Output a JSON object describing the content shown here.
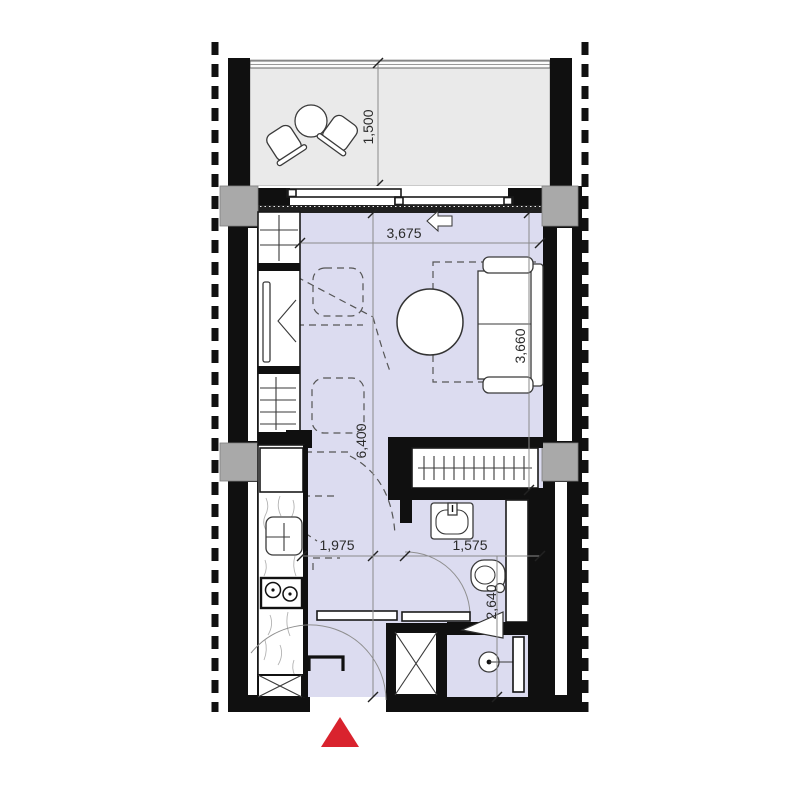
{
  "plan": {
    "type": "apartment-floor-plan",
    "dimensions": {
      "balcony_depth": "1,500",
      "living_width": "3,675",
      "living_depth": "3,660",
      "unit_length": "6,400",
      "kitchen_hall_width": "1,975",
      "bathroom_width": "1,575",
      "bathroom_depth": "2,640"
    },
    "colors": {
      "wall": "#101010",
      "floor_interior": "#dcdcf0",
      "floor_balcony": "#eaeaea",
      "column": "#a9a9a9",
      "entrance_marker": "#d9232e",
      "dimension_line": "#8a8a8a"
    }
  }
}
